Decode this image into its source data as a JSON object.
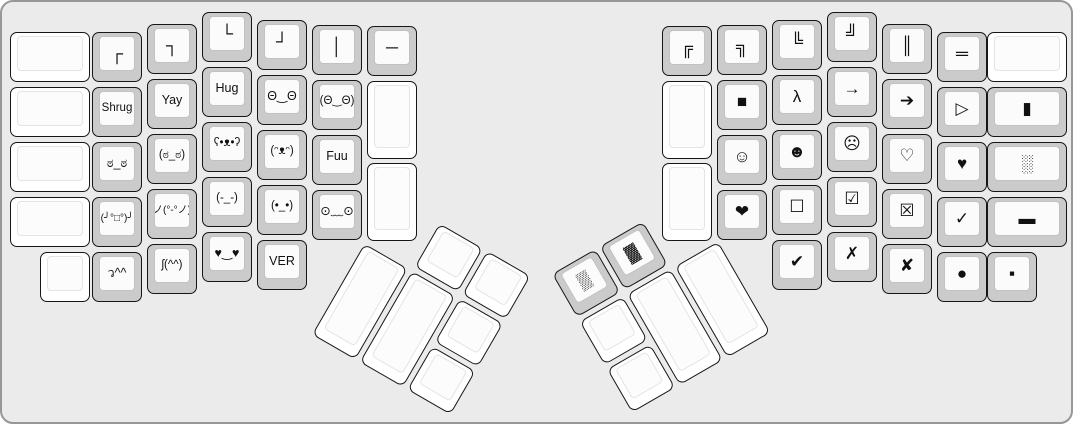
{
  "meta": {
    "background_color": "#ebebeb",
    "frame_border_color": "#979797",
    "key_outline_color": "#161616",
    "keycap_gray": "#cbcbcb",
    "keycap_white": "#ffffff",
    "legend_color": "#111111"
  },
  "keyboard": {
    "left_half": {
      "keys": [
        {
          "name": "blank",
          "label": "",
          "x": 8,
          "y": 30,
          "w": 80
        },
        {
          "name": "blank",
          "label": "",
          "x": 8,
          "y": 85,
          "w": 80
        },
        {
          "name": "blank",
          "label": "",
          "x": 8,
          "y": 140,
          "w": 80
        },
        {
          "name": "blank",
          "label": "",
          "x": 8,
          "y": 195,
          "w": 80
        },
        {
          "name": "blank",
          "label": "",
          "x": 38,
          "y": 250
        },
        {
          "name": "box-top-left",
          "label": "┌",
          "x": 90,
          "y": 30
        },
        {
          "name": "shrug",
          "label": "Shrug",
          "x": 90,
          "y": 85
        },
        {
          "name": "look-of-disapproval",
          "label": "ಠ_ಠ",
          "x": 90,
          "y": 140
        },
        {
          "name": "table-flip",
          "label": "(╯°□°)╯",
          "x": 90,
          "y": 195
        },
        {
          "name": "dance-left",
          "label": "ว^^",
          "x": 90,
          "y": 250
        },
        {
          "name": "box-top-right",
          "label": "┐",
          "x": 145,
          "y": 22
        },
        {
          "name": "yay",
          "label": "Yay",
          "x": 145,
          "y": 77
        },
        {
          "name": "look-of-disapproval-parens",
          "label": "(ಠ_ಠ)",
          "x": 145,
          "y": 132
        },
        {
          "name": "table-unflip",
          "label": "ノ(°-°ノ)",
          "x": 145,
          "y": 187
        },
        {
          "name": "dance-right",
          "label": "ʃ(^^)",
          "x": 145,
          "y": 242
        },
        {
          "name": "box-bottom-left",
          "label": "└",
          "x": 200,
          "y": 10
        },
        {
          "name": "hug",
          "label": "Hug",
          "x": 200,
          "y": 65
        },
        {
          "name": "bear-face",
          "label": "ʕ•ᴥ•ʔ",
          "x": 200,
          "y": 120
        },
        {
          "name": "expressionless-face",
          "label": "(-_-)",
          "x": 200,
          "y": 175
        },
        {
          "name": "heart-eyes",
          "label": "♥‿♥",
          "x": 200,
          "y": 230
        },
        {
          "name": "box-bottom-right",
          "label": "┘",
          "x": 255,
          "y": 18
        },
        {
          "name": "wide-eyes",
          "label": "Θ‿Θ",
          "x": 255,
          "y": 73
        },
        {
          "name": "happy-bear",
          "label": "(ᵔᴥᵔ)",
          "x": 255,
          "y": 128
        },
        {
          "name": "dot-eyes",
          "label": "(•_•)",
          "x": 255,
          "y": 183
        },
        {
          "name": "ver",
          "label": "VER",
          "x": 255,
          "y": 238
        },
        {
          "name": "box-vertical",
          "label": "│",
          "x": 310,
          "y": 23
        },
        {
          "name": "wide-eyes-parens",
          "label": "(Θ‿Θ)",
          "x": 310,
          "y": 78
        },
        {
          "name": "fuu",
          "label": "Fuu",
          "x": 310,
          "y": 133
        },
        {
          "name": "worried-face",
          "label": "⊙﹏⊙",
          "x": 310,
          "y": 188
        },
        {
          "name": "box-horizontal",
          "label": "─",
          "x": 365,
          "y": 24
        },
        {
          "name": "blank",
          "label": "",
          "x": 365,
          "y": 79,
          "h": 78
        },
        {
          "name": "blank",
          "label": "",
          "x": 365,
          "y": 161,
          "h": 78
        }
      ]
    },
    "right_half": {
      "keys": [
        {
          "name": "double-box-top-left",
          "label": "╔",
          "x": 660,
          "y": 24
        },
        {
          "name": "blank",
          "label": "",
          "x": 660,
          "y": 79,
          "h": 78
        },
        {
          "name": "blank",
          "label": "",
          "x": 660,
          "y": 161,
          "h": 78
        },
        {
          "name": "double-box-top-right",
          "label": "╗",
          "x": 715,
          "y": 23
        },
        {
          "name": "black-square",
          "label": "■",
          "x": 715,
          "y": 78
        },
        {
          "name": "white-smiley",
          "label": "☺",
          "x": 715,
          "y": 133
        },
        {
          "name": "heavy-heart",
          "label": "❤",
          "x": 715,
          "y": 188
        },
        {
          "name": "double-box-bottom-left",
          "label": "╚",
          "x": 770,
          "y": 18
        },
        {
          "name": "lambda",
          "label": "λ",
          "x": 770,
          "y": 73
        },
        {
          "name": "black-smiley",
          "label": "☻",
          "x": 770,
          "y": 128
        },
        {
          "name": "ballot-box",
          "label": "☐",
          "x": 770,
          "y": 183
        },
        {
          "name": "heavy-check-mark",
          "label": "✔",
          "x": 770,
          "y": 238
        },
        {
          "name": "double-box-bottom-right",
          "label": "╝",
          "x": 825,
          "y": 10
        },
        {
          "name": "arrow-right",
          "label": "→",
          "x": 825,
          "y": 65
        },
        {
          "name": "frowning-face",
          "label": "☹",
          "x": 825,
          "y": 120
        },
        {
          "name": "ballot-box-check",
          "label": "☑",
          "x": 825,
          "y": 175
        },
        {
          "name": "ballot-x",
          "label": "✗",
          "x": 825,
          "y": 230
        },
        {
          "name": "double-box-vertical",
          "label": "║",
          "x": 880,
          "y": 22
        },
        {
          "name": "heavy-arrow-right",
          "label": "➔",
          "x": 880,
          "y": 77
        },
        {
          "name": "white-heart",
          "label": "♡",
          "x": 880,
          "y": 132
        },
        {
          "name": "ballot-box-x",
          "label": "☒",
          "x": 880,
          "y": 187
        },
        {
          "name": "heavy-ballot-x",
          "label": "✘",
          "x": 880,
          "y": 242
        },
        {
          "name": "double-box-horizontal",
          "label": "═",
          "x": 935,
          "y": 30
        },
        {
          "name": "white-triangle-right",
          "label": "▷",
          "x": 935,
          "y": 85
        },
        {
          "name": "black-heart",
          "label": "♥",
          "x": 935,
          "y": 140
        },
        {
          "name": "check-mark",
          "label": "✓",
          "x": 935,
          "y": 195
        },
        {
          "name": "black-circle",
          "label": "●",
          "x": 935,
          "y": 250
        },
        {
          "name": "blank",
          "label": "",
          "x": 985,
          "y": 30,
          "w": 80
        },
        {
          "name": "black-vertical-rect",
          "label": "▮",
          "x": 985,
          "y": 85,
          "w": 80
        },
        {
          "name": "light-shade",
          "label": "░",
          "x": 985,
          "y": 140,
          "w": 80
        },
        {
          "name": "black-rect",
          "label": "▬",
          "x": 985,
          "y": 195,
          "w": 80
        },
        {
          "name": "black-small-square",
          "label": "▪",
          "x": 985,
          "y": 250
        }
      ]
    },
    "left_thumb": {
      "origin_x": 390,
      "origin_y": 194,
      "rotation_deg": 30,
      "keys": [
        {
          "name": "blank",
          "label": "",
          "x": 55,
          "y": 0
        },
        {
          "name": "blank",
          "label": "",
          "x": 110,
          "y": 0
        },
        {
          "name": "blank",
          "label": "",
          "x": 0,
          "y": 55,
          "h": 105
        },
        {
          "name": "blank",
          "label": "",
          "x": 55,
          "y": 55,
          "h": 105
        },
        {
          "name": "blank",
          "label": "",
          "x": 110,
          "y": 55
        },
        {
          "name": "blank",
          "label": "",
          "x": 110,
          "y": 110
        }
      ]
    },
    "right_thumb": {
      "origin_x": 550,
      "origin_y": 272,
      "rotation_deg": -30,
      "keys": [
        {
          "name": "medium-shade",
          "label": "▒",
          "x": 0,
          "y": 0
        },
        {
          "name": "dark-shade",
          "label": "▓",
          "x": 55,
          "y": 0
        },
        {
          "name": "blank",
          "label": "",
          "x": 0,
          "y": 55
        },
        {
          "name": "blank",
          "label": "",
          "x": 0,
          "y": 110
        },
        {
          "name": "blank",
          "label": "",
          "x": 55,
          "y": 55,
          "h": 105
        },
        {
          "name": "blank",
          "label": "",
          "x": 110,
          "y": 55,
          "h": 105
        }
      ]
    }
  }
}
